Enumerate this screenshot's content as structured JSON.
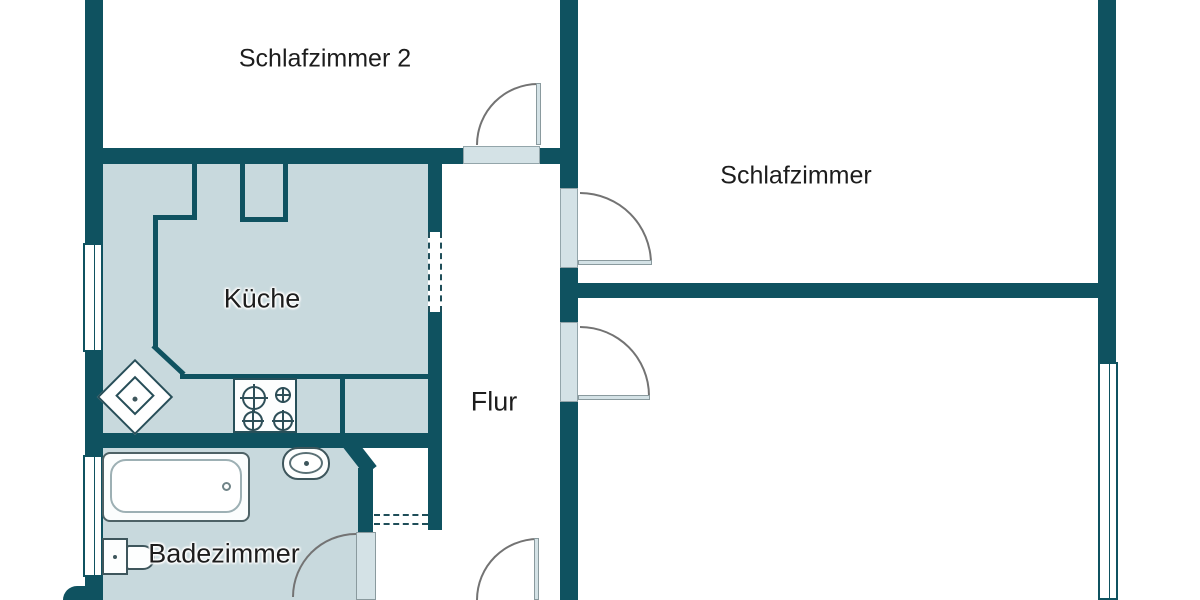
{
  "plan": {
    "type": "apartment-floor-plan",
    "language": "de"
  },
  "rooms": {
    "schlafzimmer2": {
      "label": "Schlafzimmer 2"
    },
    "schlafzimmer": {
      "label": "Schlafzimmer"
    },
    "kueche": {
      "label": "Küche"
    },
    "flur": {
      "label": "Flur"
    },
    "badezimmer": {
      "label": "Badezimmer"
    }
  },
  "fixtures": [
    "bathtub",
    "washbasin",
    "toilet",
    "stove-4-burners",
    "corner-sink-diamond",
    "window-kitchen-left",
    "window-bath-left",
    "window-right",
    "door-schlafzimmer2",
    "door-schlafzimmer",
    "door-lower-room",
    "door-bathroom",
    "door-entrance",
    "pass-through-dashed-opening",
    "niche-dashed-lines",
    "wall-shaft-notch"
  ],
  "colors": {
    "wall": "#0f5260",
    "room_fill": "#c8d9dd",
    "door_fill": "#d4e2e6",
    "arc": "#737373",
    "fixture_outline": "#3e565c",
    "label_color": "#1d1d1d",
    "background": "#ffffff"
  }
}
